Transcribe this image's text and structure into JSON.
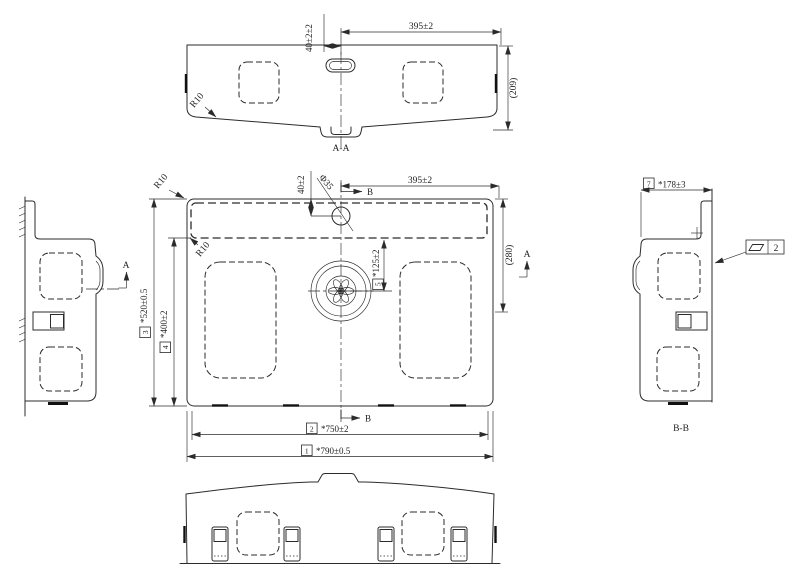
{
  "view_labels": {
    "aa": "A-A",
    "bb": "B-B"
  },
  "section_markers": {
    "a": "A",
    "b": "B"
  },
  "dims": {
    "aa_40": "40±2±2",
    "aa_395": "395±2",
    "aa_209": "(209)",
    "aa_r10": "R10",
    "plan_40": "40±2",
    "plan_phi35": "Φ35",
    "plan_395": "395±2",
    "plan_280": "(280)",
    "plan_125": "*125±2",
    "plan_520": "*520±0.5",
    "plan_400": "*400±2",
    "plan_750": "*750±2",
    "plan_790": "*790±0.5",
    "plan_r10_outer": "R10",
    "plan_r10_deck": "R10",
    "bb_178": "*178±3"
  },
  "balloon_ids": {
    "d790": "1",
    "d750": "2",
    "d520": "3",
    "d400": "4",
    "d125": "5",
    "d178": "7"
  },
  "gdt": {
    "flatness_value": "2"
  },
  "colors": {
    "line": "#2b2b2b",
    "background": "#ffffff"
  }
}
